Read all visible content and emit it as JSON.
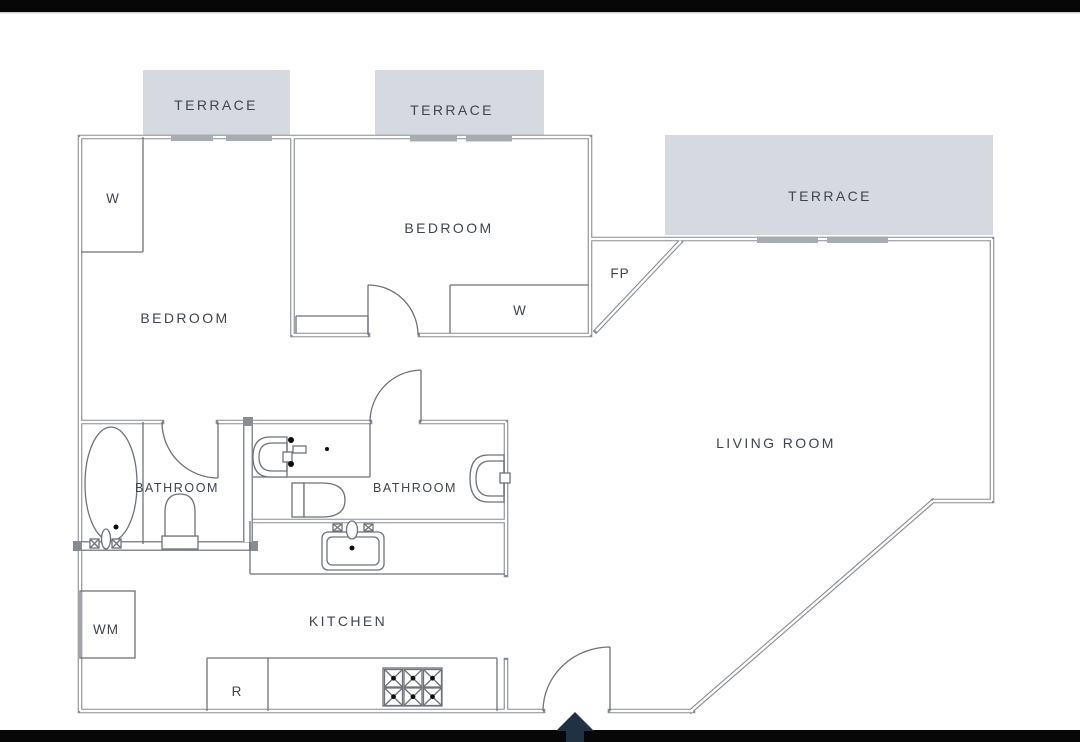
{
  "plan": {
    "title": "apartment-floor-plan",
    "labels": {
      "terrace_top_left": "TERRACE",
      "terrace_top_mid": "TERRACE",
      "terrace_right": "TERRACE",
      "bedroom_left": "BEDROOM",
      "bedroom_mid": "BEDROOM",
      "living_room": "LIVING ROOM",
      "bathroom_left": "BATHROOM",
      "bathroom_mid": "BATHROOM",
      "kitchen": "KITCHEN",
      "wardrobe_left": "W",
      "wardrobe_mid": "W",
      "fireplace": "FP",
      "washing_machine": "WM",
      "refrigerator": "R"
    },
    "colors": {
      "background": "#ffffff",
      "letterbox": "#070707",
      "terrace_fill": "#d6dae0",
      "wall": "#888d93",
      "fixture": "#6e737a",
      "window_bar": "#a8acb1",
      "text": "#3e454e",
      "arrow": "#1f3142"
    }
  }
}
